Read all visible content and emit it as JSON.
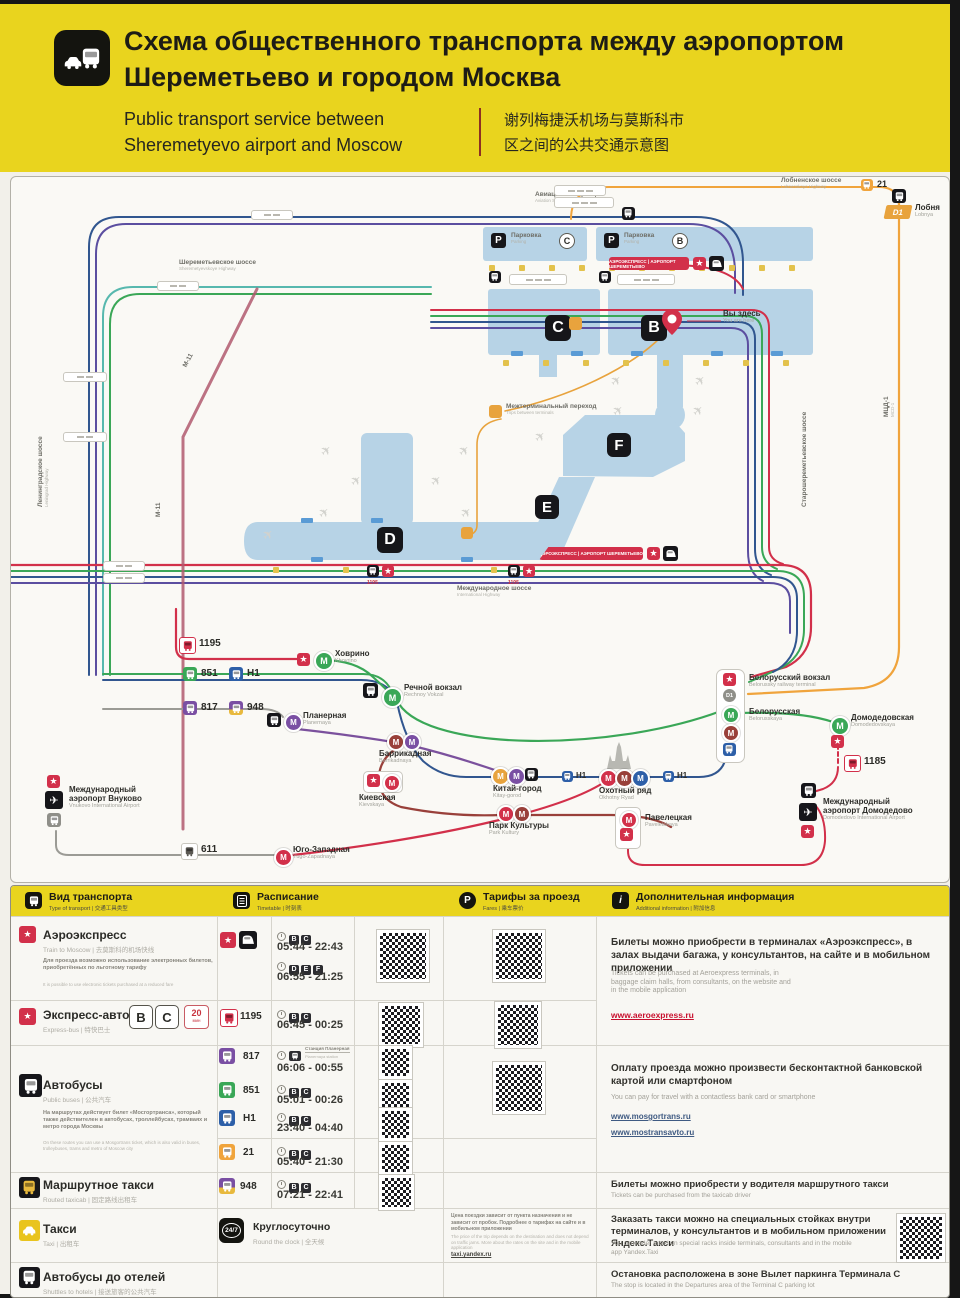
{
  "header": {
    "title1": "Схема общественного транспорта между аэропортом",
    "title2": "Шереметьево и городом Москва",
    "en1": "Public transport service between",
    "en2": "Sheremetyevo airport and Moscow",
    "zh1": "谢列梅捷沃机场与莫斯科市",
    "zh2": "区之间的公共交通示意图"
  },
  "map": {
    "terminals": {
      "b": "B",
      "c": "C",
      "d": "D",
      "e": "E",
      "f": "F"
    },
    "parking": {
      "ru": "Парковка",
      "en": "Parking"
    },
    "you_are_here": {
      "ru": "Вы здесь",
      "en": "You are here"
    },
    "walkway": {
      "ru": "Межтерминальный переход",
      "en": "Trips between terminals"
    },
    "aeroexpress_banner": "АЭРОЭКСПРЕСС | АЭРОПОРТ ШЕРЕМЕТЬЕВО",
    "roads": {
      "sheremetyevskoye": {
        "ru": "Шереметьевское шоссе",
        "en": "Sheremetyevskoye Highway"
      },
      "leningradskoye": {
        "ru": "Ленинградское шоссе",
        "en": "Leningrad Highway"
      },
      "mezhdunarodnoye": {
        "ru": "Международное шоссе",
        "en": "International Highway"
      },
      "lobnenskoye": {
        "ru": "Лобненское шоссе",
        "en": "Lobnenskoye Highway"
      },
      "aviatsionnaya": {
        "ru": "Авиационная улица",
        "en": "Aviation Street"
      },
      "starosheremetyevskoye": {
        "ru": "Старошереметьевское шоссе"
      },
      "m11": "М-11",
      "mcd1": {
        "ru": "МЦД-1",
        "en": "MCD-1"
      }
    },
    "routes": {
      "21": "21",
      "611": "611",
      "817": "817",
      "851": "851",
      "948": "948",
      "1185": "1185",
      "1195": "1195",
      "h1": "H1",
      "d1": "D1"
    },
    "stations": {
      "lobnya": {
        "ru": "Лобня",
        "en": "Lobnya"
      },
      "khovrino": {
        "ru": "Ховрино",
        "en": "Khovrino"
      },
      "rechnoy": {
        "ru": "Речной вокзал",
        "en": "Rechnoy Vokzal"
      },
      "planernaya": {
        "ru": "Планерная",
        "en": "Planernaya"
      },
      "barrikadnaya": {
        "ru": "Баррикадная",
        "en": "Barrikadnaya"
      },
      "kievskaya": {
        "ru": "Киевская",
        "en": "Kievskaya"
      },
      "kitaygorod": {
        "ru": "Китай-город",
        "en": "Kitay-gorod"
      },
      "okhotny": {
        "ru": "Охотный ряд",
        "en": "Okhotny Ryad"
      },
      "parkkultury": {
        "ru": "Парк Культуры",
        "en": "Park Kultury"
      },
      "paveletskaya": {
        "ru": "Павелецкая",
        "en": "Paveletskaya"
      },
      "belorussky": {
        "ru": "Белорусский вокзал",
        "en": "Belorussky railway terminal"
      },
      "belorusskaya": {
        "ru": "Белорусская",
        "en": "Belorusskaya"
      },
      "domodedovskaya": {
        "ru": "Домодедовская",
        "en": "Domodedovskaya"
      },
      "domodedovo": {
        "ru1": "Международный",
        "ru2": "аэропорт Домодедово",
        "en": "Domodedovo International Airport"
      },
      "vnukovo": {
        "ru1": "Международный",
        "ru2": "аэропорт Внуково",
        "en": "Vnukovo International Airport"
      },
      "yugozapadnaya": {
        "ru": "Юго-Западная",
        "en": "Yugo-Zapadnaya"
      }
    }
  },
  "table": {
    "header": {
      "type": {
        "ru": "Вид транспорта",
        "sub": "Type of transport | 交通工具类型"
      },
      "timetable": {
        "ru": "Расписание",
        "sub": "Timetable | 时刻表"
      },
      "fares": {
        "ru": "Тарифы за проезд",
        "sub": "Fares | 乘车票价"
      },
      "info": {
        "ru": "Дополнительная информация",
        "sub": "Additional information | 附加信息"
      }
    },
    "aeroexpress": {
      "title": "Аэроэкспресс",
      "sub": "Train to Moscow | 去莫斯科的机场快线",
      "note_ru": "Для проезда возможно использование электронных билетов, приобретённых по льготному тарифу",
      "note_en": "It is possible to use electronic tickets purchased at a reduced fare",
      "t1": [
        "B",
        "C"
      ],
      "time1": "05:44 - 22:43",
      "t2": [
        "D",
        "E",
        "F"
      ],
      "time2": "06:55 - 21:25"
    },
    "express": {
      "title": "Экспресс-автобус",
      "sub": "Express-bus | 特快巴士",
      "badge1": "B",
      "badge2": "C",
      "freq": "20",
      "freq_unit": "мин",
      "route": "1195",
      "t": [
        "B",
        "C"
      ],
      "time": "06:45 - 00:25"
    },
    "buses": {
      "title": "Автобусы",
      "sub": "Public buses | 公共汽车",
      "note_ru": "На маршрутах действует билет «Мосгортранса», который также действителен в автобусах, троллейбусах, трамваях и метро города Москвы",
      "note_en": "On these routes you can use a Mosgortrans ticket, which is also valid in buses, trolleybuses, trams and metro of Moscow city",
      "e817": {
        "route": "817",
        "station_ru": "Станция Планерная",
        "station_en": "Planernaya station",
        "time": "06:06 - 00:55"
      },
      "e851": {
        "route": "851",
        "t": [
          "B",
          "C"
        ],
        "time": "05:01 - 00:26"
      },
      "eh1": {
        "route": "H1",
        "t": [
          "B",
          "C"
        ],
        "time": "23:40 - 04:40"
      },
      "e21": {
        "route": "21",
        "t": [
          "B",
          "C"
        ],
        "time": "05:40 - 21:30"
      }
    },
    "routed": {
      "title": "Маршрутное такси",
      "sub": "Routed taxicab | 固定路线出租车",
      "route": "948",
      "t": [
        "B",
        "C"
      ],
      "time": "07:21 - 22:41"
    },
    "taxi": {
      "title": "Такси",
      "sub": "Taxi | 出租车",
      "roundclock_ru": "Круглосуточно",
      "roundclock_sub": "Round the clock | 全天候",
      "badge": "24/7",
      "fare_ru": "Цена поездки зависит от пункта назначения и не зависит от пробок. Подробнее о тарифах на сайте и в мобильном приложении",
      "fare_en": "The price of the trip depends on the destination and does not depend on traffic jams. More about the rates on the site and in the mobile application",
      "link": "taxi.yandex.ru"
    },
    "shuttles": {
      "title": "Автобусы до отелей",
      "sub": "Shuttles to hotels | 接送旅客的公共汽车"
    },
    "info": {
      "aero_ru": "Билеты можно приобрести в терминалах «Аэроэкспресс», в залах выдачи багажа, у консультантов, на сайте и в мобильном приложении",
      "aero_en": "Tickets can be purchased at Aeroexpress terminals, in baggage claim halls, from consultants, on the website and in the mobile application",
      "aero_link": "www.aeroexpress.ru",
      "pay_ru": "Оплату проезда можно произвести бесконтактной банковской картой или смартфоном",
      "pay_en": "You can pay for travel with a contactless bank card or smartphone",
      "pay_link1": "www.mosgortrans.ru",
      "pay_link2": "www.mostransavto.ru",
      "driver_ru": "Билеты можно приобрести у водителя маршрутного такси",
      "driver_en": "Tickets can be purchased from the taxicab driver",
      "order_ru": "Заказать такси можно на специальных стойках внутри терминалов, у консультантов и в мобильном приложении Яндекс.Такси",
      "order_en": "You can order a taxi on special racks inside terminals, consultants and in the mobile app Yandex.Taxi",
      "stop_ru": "Остановка расположена в зоне Вылет паркинга Терминала C",
      "stop_en": "The stop is located in the Departures area of the Terminal C parking lot"
    }
  }
}
